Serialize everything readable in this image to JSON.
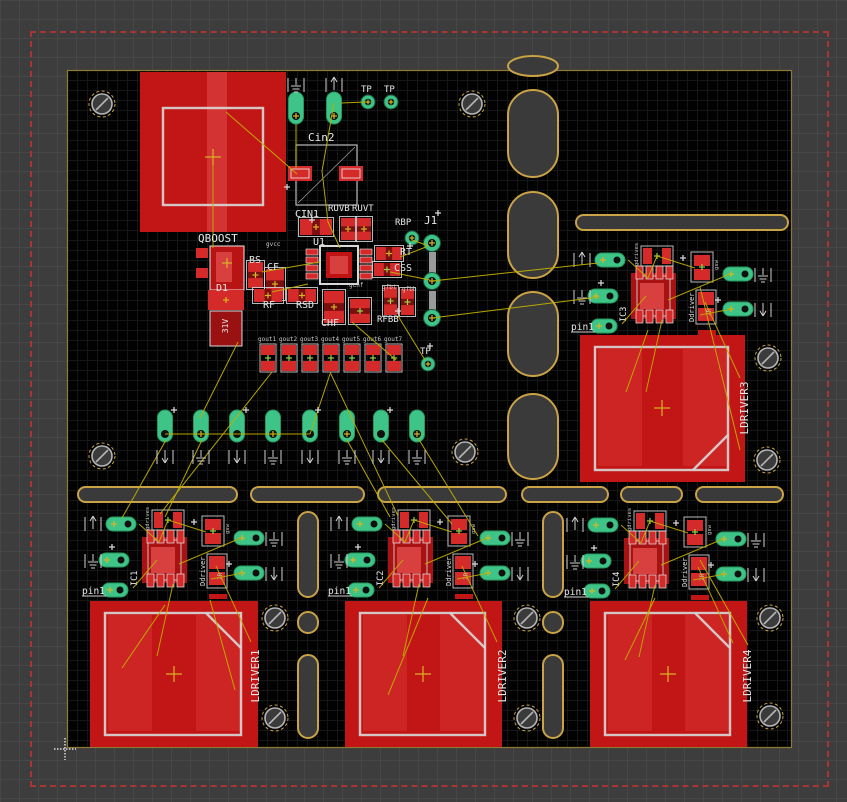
{
  "editor": {
    "name": "pcb-board-layout-canvas"
  },
  "colors": {
    "copper": "#c21616",
    "pad": "#d42a2a",
    "pad_dark": "#a81212",
    "pad_light": "#d84040",
    "silk": "#d8d8d8",
    "green": "#3ec487",
    "green_dark": "#27995f",
    "gold": "#c9a345",
    "board_edge": "#8f7a33",
    "ratsnest": "#bfae00",
    "cross_yellow": "#d8b622",
    "cross_green": "#9ad34a",
    "hole_ring": "#b5b5b5",
    "text": "#e6e6e6",
    "tiny": "#c8c8c8",
    "dash_red": "#a83434"
  },
  "board": {
    "x": 67,
    "y": 70,
    "w": 725,
    "h": 678
  },
  "dashed_rect": {
    "x": 30,
    "y": 31,
    "w": 795,
    "h": 752
  },
  "origin_marker": {
    "x": 65,
    "y": 749
  },
  "labels": [
    {
      "t": "TP",
      "x": 361,
      "y": 92,
      "s": 9
    },
    {
      "t": "TP",
      "x": 384,
      "y": 92,
      "s": 9
    },
    {
      "t": "Cin2",
      "x": 308,
      "y": 141,
      "s": 11
    },
    {
      "t": "CIN1",
      "x": 295,
      "y": 217,
      "s": 10
    },
    {
      "t": "RUVB",
      "x": 328,
      "y": 211,
      "s": 9
    },
    {
      "t": "RUVT",
      "x": 352,
      "y": 211,
      "s": 9
    },
    {
      "t": "RBP",
      "x": 395,
      "y": 225,
      "s": 9
    },
    {
      "t": "J1",
      "x": 424,
      "y": 224,
      "s": 11
    },
    {
      "t": "U1",
      "x": 313,
      "y": 245,
      "s": 10
    },
    {
      "t": "QBOOST",
      "x": 198,
      "y": 242,
      "s": 11
    },
    {
      "t": "BS",
      "x": 249,
      "y": 263,
      "s": 10
    },
    {
      "t": "CF",
      "x": 267,
      "y": 270,
      "s": 10
    },
    {
      "t": "RT",
      "x": 400,
      "y": 255,
      "s": 10
    },
    {
      "t": "CSS",
      "x": 394,
      "y": 271,
      "s": 10
    },
    {
      "t": "D1",
      "x": 216,
      "y": 291,
      "s": 10
    },
    {
      "t": "RF",
      "x": 263,
      "y": 308,
      "s": 10
    },
    {
      "t": "RSD",
      "x": 296,
      "y": 308,
      "s": 10
    },
    {
      "t": "CHF",
      "x": 321,
      "y": 326,
      "s": 10
    },
    {
      "t": "RFBB",
      "x": 377,
      "y": 322,
      "s": 9
    },
    {
      "t": "TP",
      "x": 420,
      "y": 354,
      "s": 9
    },
    {
      "t": "31V",
      "x": 228,
      "y": 326,
      "s": 8,
      "r": -90,
      "a": "m"
    }
  ],
  "tiny_labels": [
    {
      "t": "gvcc",
      "x": 266,
      "y": 246
    },
    {
      "t": "gchf",
      "x": 349,
      "y": 287
    },
    {
      "t": "gfbt",
      "x": 382,
      "y": 289
    },
    {
      "t": "gfbb",
      "x": 402,
      "y": 291
    }
  ],
  "gout_labels": [
    "gout1",
    "gout2",
    "gout3",
    "gout4",
    "gout5",
    "gout6",
    "gout7"
  ],
  "gout_row": {
    "cx0": 268,
    "dx": 21,
    "y": 344,
    "w": 16,
    "h": 28,
    "label_y": 341
  },
  "mount_holes": [
    [
      102,
      104
    ],
    [
      472,
      104
    ],
    [
      102,
      456
    ],
    [
      465,
      452
    ],
    [
      768,
      358
    ],
    [
      767,
      460
    ],
    [
      275,
      618
    ],
    [
      275,
      718
    ],
    [
      527,
      618
    ],
    [
      527,
      718
    ],
    [
      770,
      618
    ],
    [
      770,
      716
    ]
  ],
  "slots_v": [
    [
      508,
      56,
      50,
      20
    ],
    [
      508,
      90,
      50,
      87
    ],
    [
      508,
      192,
      50,
      86
    ],
    [
      508,
      292,
      50,
      84
    ],
    [
      508,
      394,
      50,
      85
    ],
    [
      298,
      512,
      20,
      85
    ],
    [
      298,
      612,
      20,
      21
    ],
    [
      298,
      655,
      20,
      83
    ],
    [
      543,
      512,
      20,
      85
    ],
    [
      543,
      612,
      20,
      21
    ],
    [
      543,
      655,
      20,
      83
    ]
  ],
  "slots_h": [
    [
      576,
      215,
      212,
      15
    ],
    [
      78,
      487,
      159,
      15
    ],
    [
      251,
      487,
      113,
      15
    ],
    [
      378,
      487,
      128,
      15
    ],
    [
      522,
      487,
      86,
      15
    ],
    [
      621,
      487,
      61,
      15
    ],
    [
      696,
      487,
      87,
      15
    ]
  ],
  "qboost_pad": {
    "x": 140,
    "y": 72,
    "w": 146,
    "h": 160,
    "frame": [
      163,
      108,
      100,
      97
    ]
  },
  "ring_pads": [
    [
      368,
      102
    ],
    [
      391,
      102
    ],
    [
      412,
      238
    ],
    [
      428,
      364
    ]
  ],
  "j1_pads": [
    [
      432,
      243
    ],
    [
      432,
      281
    ],
    [
      432,
      318
    ]
  ],
  "j1_connectors": [
    [
      429,
      252,
      7,
      22
    ],
    [
      429,
      291,
      7,
      22
    ]
  ],
  "top_ovals": [
    [
      296,
      108
    ],
    [
      334,
      108
    ]
  ],
  "oval_row": {
    "xs": [
      165,
      201,
      237,
      273,
      310,
      347,
      381,
      417
    ],
    "y": 426
  },
  "components": [
    [
      300,
      219,
      32,
      16,
      0,
      "y"
    ],
    [
      341,
      218,
      14,
      22,
      1,
      "y"
    ],
    [
      357,
      218,
      14,
      22,
      1,
      "y"
    ],
    [
      376,
      247,
      26,
      13,
      0,
      "y"
    ],
    [
      374,
      263,
      26,
      13,
      0,
      "g"
    ],
    [
      248,
      262,
      15,
      26,
      1,
      "y"
    ],
    [
      266,
      269,
      18,
      30,
      1,
      "y"
    ],
    [
      254,
      289,
      28,
      13,
      0,
      "y"
    ],
    [
      288,
      289,
      28,
      13,
      0,
      "y"
    ],
    [
      324,
      291,
      20,
      32,
      1,
      "y"
    ],
    [
      350,
      299,
      20,
      24,
      1,
      "g"
    ],
    [
      384,
      287,
      13,
      28,
      1,
      "g"
    ],
    [
      401,
      289,
      13,
      26,
      1,
      "g"
    ]
  ],
  "cin2": {
    "frame": [
      296,
      145,
      61,
      60
    ],
    "pads": [
      [
        288,
        166,
        24,
        15
      ],
      [
        339,
        166,
        24,
        15
      ]
    ]
  },
  "u1": {
    "frame": [
      320,
      246,
      38,
      38
    ],
    "inner": [
      326,
      252,
      26,
      26
    ],
    "core": [
      330,
      256,
      18,
      18
    ],
    "left_x": 306,
    "right_x": 360,
    "pad_y0": 249,
    "pad_dy": 8,
    "pad_n": 4
  },
  "qboost_comp": {
    "body": [
      210,
      246,
      34,
      44
    ],
    "pads": [
      [
        196,
        248,
        12,
        10
      ],
      [
        196,
        268,
        12,
        10
      ]
    ],
    "core": [
      216,
      252,
      16,
      30
    ],
    "cross": [
      227,
      263
    ]
  },
  "d1": {
    "top_pad": [
      208,
      290,
      36,
      20
    ],
    "body": [
      210,
      311,
      32,
      35
    ],
    "cross": [
      226,
      300
    ]
  },
  "crosses_yellow": [
    [
      213,
      157
    ],
    [
      174,
      674
    ],
    [
      423,
      674
    ],
    [
      668,
      674
    ],
    [
      662,
      408
    ]
  ],
  "pluses_white": [
    [
      438,
      213
    ],
    [
      410,
      246
    ],
    [
      312,
      220
    ],
    [
      287,
      187
    ],
    [
      174,
      410
    ],
    [
      246,
      410
    ],
    [
      318,
      410
    ],
    [
      390,
      410
    ],
    [
      398,
      311
    ],
    [
      430,
      346
    ]
  ],
  "symbols": [
    [
      "gnd",
      296,
      84
    ],
    [
      "up",
      334,
      84
    ],
    [
      "down",
      165,
      456
    ],
    [
      "gnd",
      201,
      456
    ],
    [
      "down",
      237,
      456
    ],
    [
      "gnd",
      273,
      456
    ],
    [
      "down",
      310,
      456
    ],
    [
      "gnd",
      347,
      456
    ],
    [
      "down",
      381,
      456
    ],
    [
      "gnd",
      417,
      456
    ]
  ],
  "clusters": [
    {
      "ref": "IC1",
      "x": 121,
      "y": 524,
      "sq": [
        90,
        601,
        168,
        146
      ],
      "sq_label": "LDRIVER1",
      "sq_label_pos": [
        259,
        676
      ],
      "chamfer": "tr"
    },
    {
      "ref": "IC2",
      "x": 367,
      "y": 524,
      "sq": [
        345,
        601,
        157,
        146
      ],
      "sq_label": "LDRIVER2",
      "sq_label_pos": [
        506,
        676
      ],
      "chamfer": "tr"
    },
    {
      "ref": "IC4",
      "x": 603,
      "y": 525,
      "sq": [
        590,
        601,
        157,
        146
      ],
      "sq_label": "LDRIVER4",
      "sq_label_pos": [
        751,
        676
      ],
      "chamfer": "tr"
    },
    {
      "ref": "IC3",
      "x": 610,
      "y": 260,
      "sq": [
        580,
        335,
        165,
        147
      ],
      "sq_label": "LDRIVER3",
      "sq_label_pos": [
        748,
        408
      ],
      "chamfer": "br"
    }
  ],
  "cluster_strings": {
    "pin": "pin1",
    "driver": "Ddriver",
    "net1": "gdrives",
    "net2": "gsw",
    "val": "2R"
  },
  "cluster_ratsnest": [
    [
      18,
      0,
      38,
      18
    ],
    [
      38,
      18,
      47,
      -4
    ],
    [
      47,
      -4,
      85,
      8
    ],
    [
      36,
      36,
      12,
      64
    ],
    [
      58,
      40,
      120,
      14
    ],
    [
      90,
      55,
      122,
      49
    ],
    [
      52,
      60,
      36,
      132
    ],
    [
      95,
      42,
      130,
      118
    ]
  ],
  "ratsnest": [
    [
      226,
      112,
      297,
      174
    ],
    [
      213,
      162,
      213,
      248
    ],
    [
      334,
      103,
      322,
      171
    ],
    [
      322,
      171,
      328,
      222
    ],
    [
      341,
      103,
      366,
      102
    ],
    [
      296,
      124,
      296,
      168
    ],
    [
      412,
      240,
      429,
      246
    ],
    [
      400,
      257,
      426,
      247
    ],
    [
      432,
      281,
      598,
      263
    ],
    [
      432,
      318,
      599,
      297
    ],
    [
      390,
      272,
      430,
      280
    ],
    [
      238,
      342,
      200,
      418
    ],
    [
      310,
      434,
      330,
      374
    ],
    [
      165,
      434,
      310,
      434
    ],
    [
      166,
      440,
      122,
      518
    ],
    [
      202,
      440,
      165,
      517
    ],
    [
      347,
      440,
      390,
      517
    ],
    [
      382,
      440,
      452,
      524
    ],
    [
      418,
      438,
      478,
      536
    ],
    [
      272,
      372,
      160,
      514
    ],
    [
      330,
      372,
      398,
      516
    ],
    [
      398,
      316,
      425,
      360
    ],
    [
      352,
      322,
      396,
      360
    ],
    [
      262,
      272,
      320,
      262
    ],
    [
      272,
      292,
      308,
      284
    ],
    [
      648,
      330,
      626,
      392
    ],
    [
      700,
      287,
      740,
      450
    ],
    [
      165,
      605,
      122,
      668
    ],
    [
      210,
      600,
      235,
      690
    ],
    [
      428,
      598,
      388,
      695
    ],
    [
      655,
      598,
      625,
      660
    ],
    [
      700,
      560,
      748,
      645
    ],
    [
      328,
      222,
      340,
      248
    ]
  ]
}
